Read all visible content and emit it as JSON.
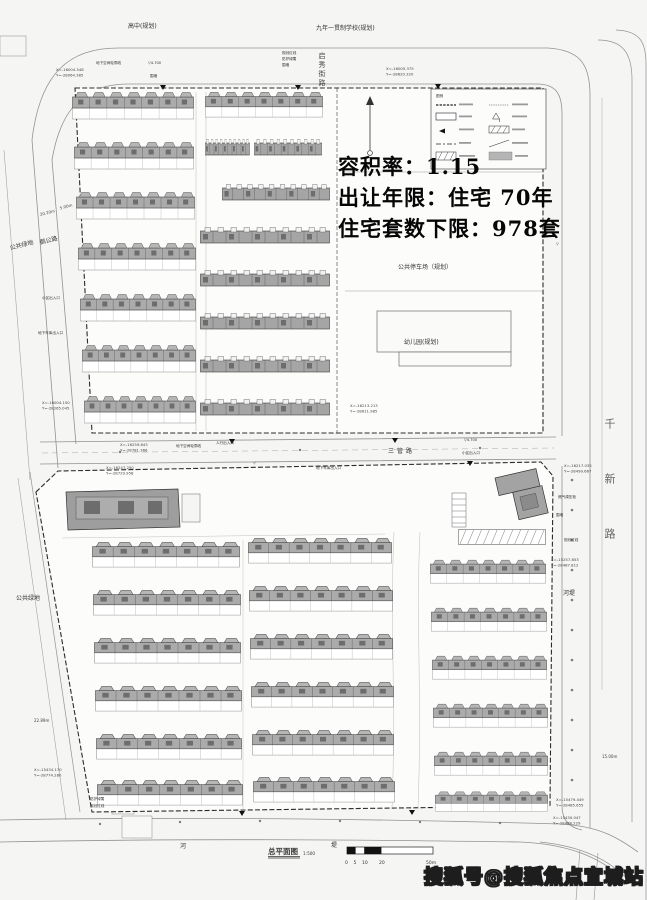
{
  "overlay": {
    "line1": "容积率：1.15",
    "line2": "出让年限：住宅 70年",
    "line3": "住宅套数下限：978套"
  },
  "watermark": {
    "text": "搜狐号@搜狐焦点宜城站"
  },
  "labels": {
    "school_left": "高中(规划)",
    "school_right": "九年一贯制学校(规划)",
    "road_qixiu": "启秀街路",
    "road_sanguan": "三管路",
    "road_qianxin": "千新路",
    "road_egong": "鹅公路",
    "green_top": "公共绿地",
    "green_bottom": "公共绿地",
    "parking": "公共停车场（规划）",
    "kindergarten": "幼儿园(规划)",
    "riverbank": "河堤",
    "river": "河",
    "levee": "堤",
    "legend_title": "图例"
  },
  "titleblock": {
    "title": "总平面图",
    "scale": "1:500",
    "ticks": [
      "0",
      "5",
      "10",
      "20",
      "50m"
    ]
  },
  "coords": [
    {
      "l1": "X=-16004.548",
      "l2": "Y=-28064.385"
    },
    {
      "l1": "X=-16005.375",
      "l2": "Y=-28620.320"
    },
    {
      "l1": "X=-16004.150",
      "l2": "Y=-28265.045"
    },
    {
      "l1": "X=-16213.213",
      "l2": "Y=-28611.985"
    },
    {
      "l1": "X=-16259.843",
      "l2": "Y=-28781.366"
    },
    {
      "l1": "X=-16247.250",
      "l2": "Y=-28729.958"
    },
    {
      "l1": "X=-16217.035",
      "l2": "Y=-28499.667"
    },
    {
      "l1": "X=-15257.853",
      "l2": "Y=-28487.812"
    },
    {
      "l1": "X=-15434.170",
      "l2": "Y=-28774.280"
    },
    {
      "l1": "X=-15479.449",
      "l2": "Y=-28485.655"
    },
    {
      "l1": "X=-15430.047",
      "l2": "Y=-28488.229"
    }
  ],
  "dims": [
    {
      "t": "20.20m"
    },
    {
      "t": "5.00m"
    },
    {
      "t": "22.89m"
    },
    {
      "t": "15.00m"
    }
  ],
  "micro": [
    {
      "t": "地下空间轮廓线"
    },
    {
      "t": "围墙"
    },
    {
      "t": "规划红线"
    },
    {
      "t": "防护绿篱"
    },
    {
      "t": "围墙"
    },
    {
      "t": "地下空间轮廓线"
    },
    {
      "t": "地下车库出入口"
    },
    {
      "t": "小区出入口"
    },
    {
      "t": "地下车库出入口"
    },
    {
      "t": "防护绿篱"
    },
    {
      "t": "规划红线"
    },
    {
      "t": "燃气调压柜"
    },
    {
      "t": "围墙"
    },
    {
      "t": "规划红线"
    },
    {
      "t": "人行出入口"
    },
    {
      "t": "小区出入口"
    }
  ],
  "colors": {
    "paper": "#f5f5f3",
    "parcel_fill": "#fcfcfb",
    "building_gray": "#a8a8a8",
    "building_dark": "#6d6d6d",
    "linework": "#8f8f8f",
    "boundary_ink": "#2b2b2b",
    "overlay_text": "#060606"
  }
}
